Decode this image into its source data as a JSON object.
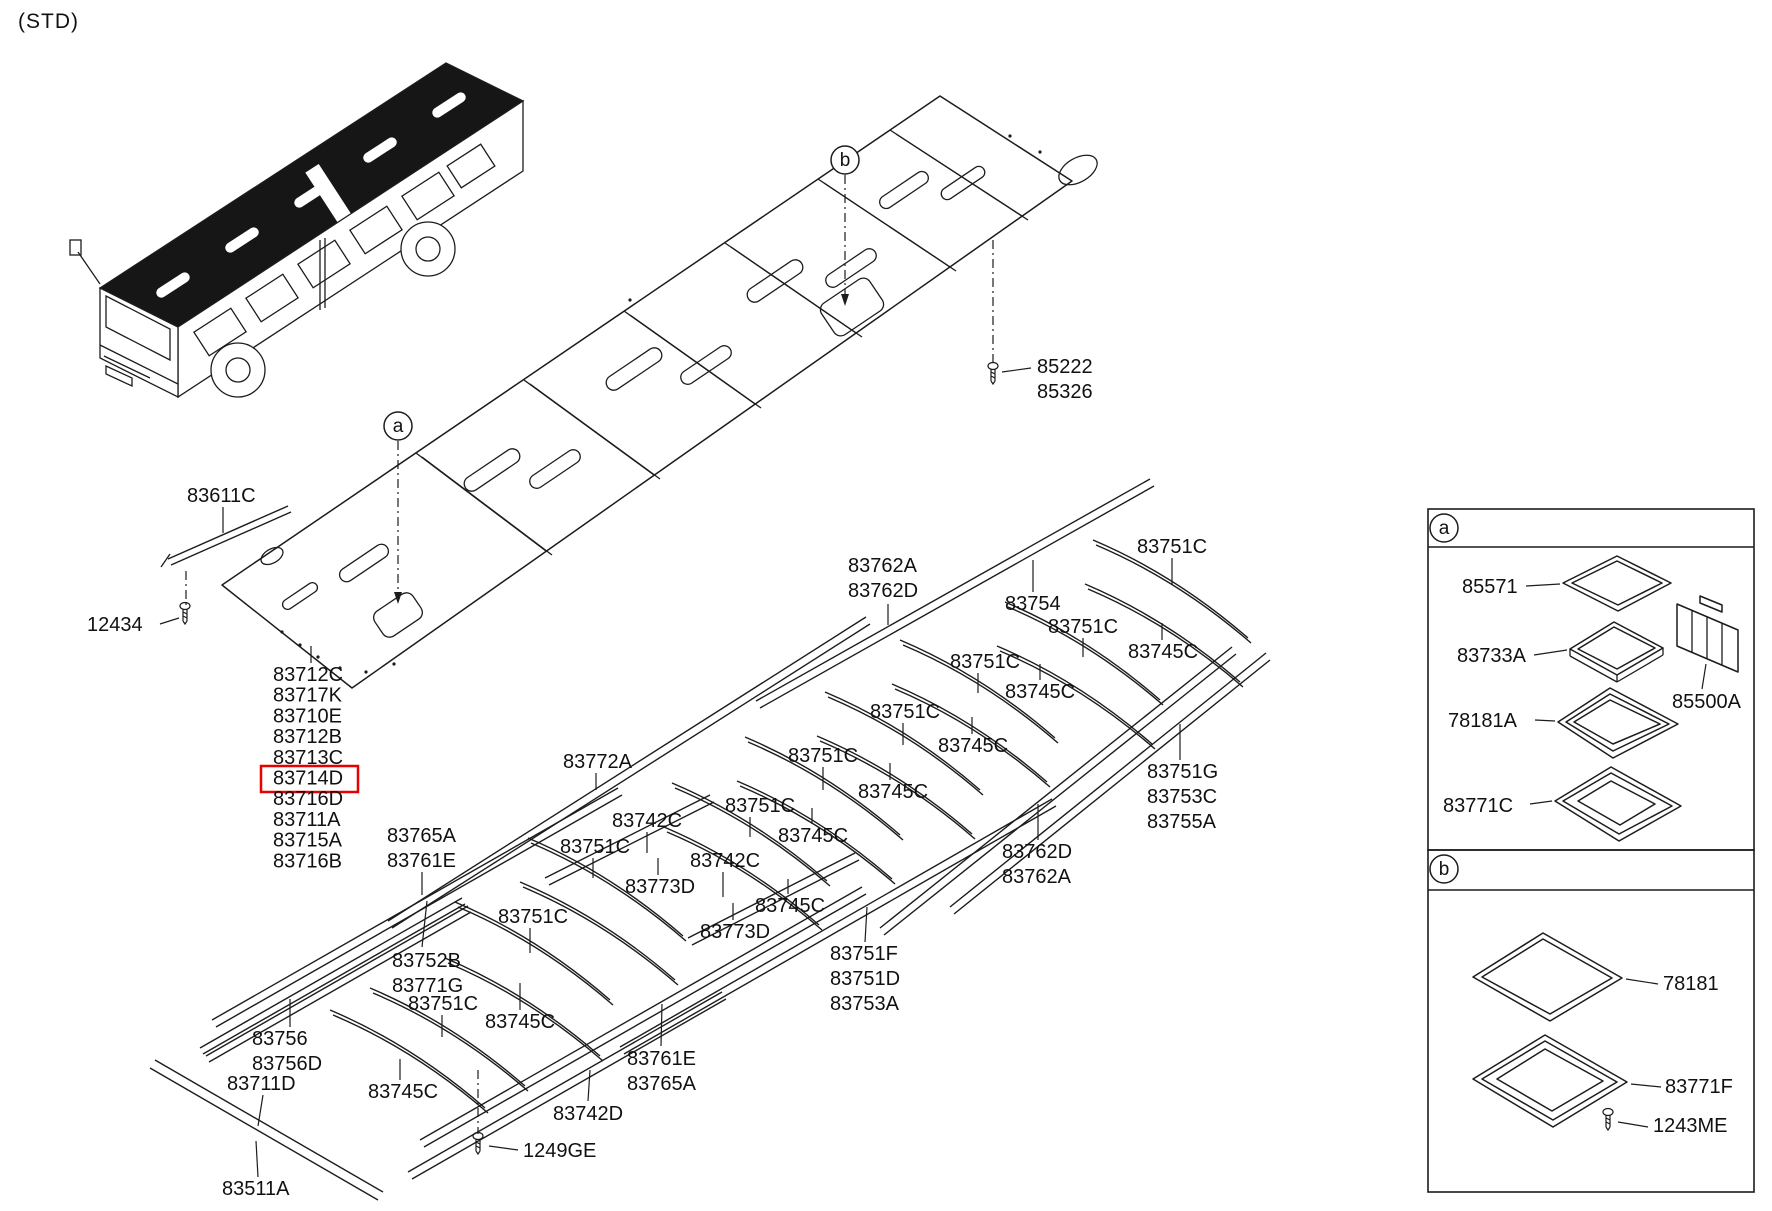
{
  "page": {
    "variant_tag": "(STD)"
  },
  "colors": {
    "line": "#1c1c1c",
    "highlight": "#e60000",
    "bg": "#ffffff"
  },
  "parts_list": {
    "x": 273,
    "y0": 681,
    "dy": 20.7,
    "items": [
      "83712C",
      "83717K",
      "83710E",
      "83712B",
      "83713C",
      "83714D",
      "83716D",
      "83711A",
      "83715A",
      "83716B"
    ],
    "highlighted_index": 5,
    "highlight_box": [
      261,
      766,
      97,
      26
    ],
    "leader": [
      311,
      646,
      311,
      663
    ]
  },
  "callouts": [
    {
      "x": 398,
      "y": 426,
      "t": "a"
    },
    {
      "x": 845,
      "y": 160,
      "t": "b"
    },
    {
      "x": 1444,
      "y": 528,
      "t": "a"
    },
    {
      "x": 1444,
      "y": 869,
      "t": "b"
    }
  ],
  "detail_boxes": [
    {
      "x": 1428,
      "y": 509,
      "w": 326,
      "h": 341,
      "div_y": 547,
      "id": "a"
    },
    {
      "x": 1428,
      "y": 850,
      "w": 326,
      "h": 342,
      "div_y": 890,
      "id": "b"
    }
  ],
  "labels": [
    {
      "n": "label-83611C",
      "t": [
        "83611C"
      ],
      "x": 187,
      "y": 502,
      "l": [
        223,
        507,
        223,
        533
      ]
    },
    {
      "n": "label-12434",
      "t": [
        "12434"
      ],
      "x": 87,
      "y": 631,
      "l": [
        160,
        624,
        179,
        618
      ]
    },
    {
      "n": "label-85222-85326",
      "t": [
        "85222",
        "85326"
      ],
      "x": 1037,
      "y": 373,
      "l": [
        1031,
        368,
        1002,
        372
      ]
    },
    {
      "n": "label-83762A-83762D",
      "t": [
        "83762A",
        "83762D"
      ],
      "x": 848,
      "y": 572,
      "l": [
        888,
        604,
        888,
        625
      ]
    },
    {
      "n": "label-83754",
      "t": [
        "83754"
      ],
      "x": 1005,
      "y": 610,
      "l": [
        1033,
        592,
        1033,
        560
      ]
    },
    {
      "n": "label-83772A",
      "t": [
        "83772A"
      ],
      "x": 563,
      "y": 768,
      "l": [
        596,
        773,
        596,
        790
      ]
    },
    {
      "n": "label-83742C-1",
      "t": [
        "83742C"
      ],
      "x": 612,
      "y": 827,
      "l": [
        647,
        832,
        647,
        853
      ]
    },
    {
      "n": "label-83742C-2",
      "t": [
        "83742C"
      ],
      "x": 690,
      "y": 867,
      "l": [
        723,
        872,
        723,
        897
      ]
    },
    {
      "n": "label-83773D-1",
      "t": [
        "83773D"
      ],
      "x": 625,
      "y": 893,
      "l": [
        658,
        875,
        658,
        858
      ]
    },
    {
      "n": "label-83773D-2",
      "t": [
        "83773D"
      ],
      "x": 700,
      "y": 938,
      "l": [
        733,
        920,
        733,
        903
      ]
    },
    {
      "n": "label-83745C-1",
      "t": [
        "83745C"
      ],
      "x": 1128,
      "y": 658,
      "l": [
        1162,
        640,
        1162,
        623
      ]
    },
    {
      "n": "label-83745C-2",
      "t": [
        "83745C"
      ],
      "x": 1005,
      "y": 698,
      "l": [
        1040,
        680,
        1040,
        664
      ]
    },
    {
      "n": "label-83745C-3",
      "t": [
        "83745C"
      ],
      "x": 938,
      "y": 752,
      "l": [
        972,
        734,
        972,
        717
      ]
    },
    {
      "n": "label-83745C-4",
      "t": [
        "83745C"
      ],
      "x": 858,
      "y": 798,
      "l": [
        890,
        780,
        890,
        763
      ]
    },
    {
      "n": "label-83745C-5",
      "t": [
        "83745C"
      ],
      "x": 778,
      "y": 842,
      "l": [
        812,
        824,
        812,
        808
      ]
    },
    {
      "n": "label-83745C-6",
      "t": [
        "83745C"
      ],
      "x": 755,
      "y": 912,
      "l": [
        788,
        894,
        788,
        879
      ]
    },
    {
      "n": "label-83745C-7",
      "t": [
        "83745C"
      ],
      "x": 485,
      "y": 1028,
      "l": [
        520,
        1010,
        520,
        983
      ]
    },
    {
      "n": "label-83745C-8",
      "t": [
        "83745C"
      ],
      "x": 368,
      "y": 1098,
      "l": [
        400,
        1080,
        400,
        1059
      ]
    },
    {
      "n": "label-83751C-1",
      "t": [
        "83751C"
      ],
      "x": 1137,
      "y": 553,
      "l": [
        1172,
        558,
        1172,
        585
      ]
    },
    {
      "n": "label-83751C-2",
      "t": [
        "83751C"
      ],
      "x": 1048,
      "y": 633,
      "l": [
        1083,
        638,
        1083,
        657
      ]
    },
    {
      "n": "label-83751C-3",
      "t": [
        "83751C"
      ],
      "x": 950,
      "y": 668,
      "l": [
        978,
        673,
        978,
        693
      ]
    },
    {
      "n": "label-83751C-4",
      "t": [
        "83751C"
      ],
      "x": 870,
      "y": 718,
      "l": [
        903,
        723,
        903,
        745
      ]
    },
    {
      "n": "label-83751C-5",
      "t": [
        "83751C"
      ],
      "x": 788,
      "y": 762,
      "l": [
        823,
        767,
        823,
        790
      ]
    },
    {
      "n": "label-83751C-6",
      "t": [
        "83751C"
      ],
      "x": 725,
      "y": 812,
      "l": [
        750,
        817,
        750,
        837
      ]
    },
    {
      "n": "label-83751C-7",
      "t": [
        "83751C"
      ],
      "x": 560,
      "y": 853,
      "l": [
        593,
        858,
        593,
        878
      ]
    },
    {
      "n": "label-83751C-8",
      "t": [
        "83751C"
      ],
      "x": 498,
      "y": 923,
      "l": [
        530,
        928,
        530,
        953
      ]
    },
    {
      "n": "label-83751C-9",
      "t": [
        "83751C"
      ],
      "x": 408,
      "y": 1010,
      "l": [
        442,
        1015,
        442,
        1037
      ]
    },
    {
      "n": "label-83765A-83761E",
      "t": [
        "83765A",
        "83761E"
      ],
      "x": 387,
      "y": 842,
      "l": [
        422,
        872,
        422,
        895
      ]
    },
    {
      "n": "label-83752B-83771G",
      "t": [
        "83752B",
        "83771G"
      ],
      "x": 392,
      "y": 967,
      "l": [
        422,
        947,
        427,
        901
      ]
    },
    {
      "n": "label-83751F-83751D-83753A",
      "t": [
        "83751F",
        "83751D",
        "83753A"
      ],
      "x": 830,
      "y": 960,
      "l": [
        865,
        942,
        867,
        907
      ]
    },
    {
      "n": "label-83762D-83762A",
      "t": [
        "83762D",
        "83762A"
      ],
      "x": 1002,
      "y": 858,
      "l": [
        1038,
        840,
        1038,
        804
      ]
    },
    {
      "n": "label-83751G-83753C-83755A",
      "t": [
        "83751G",
        "83753C",
        "83755A"
      ],
      "x": 1147,
      "y": 778,
      "l": [
        1180,
        760,
        1180,
        724
      ]
    },
    {
      "n": "label-83761E-83765A",
      "t": [
        "83761E",
        "83765A"
      ],
      "x": 627,
      "y": 1065,
      "l": [
        661,
        1046,
        662,
        1004
      ]
    },
    {
      "n": "label-83742D",
      "t": [
        "83742D"
      ],
      "x": 553,
      "y": 1120,
      "l": [
        588,
        1101,
        590,
        1070
      ]
    },
    {
      "n": "label-1249GE",
      "t": [
        "1249GE"
      ],
      "x": 523,
      "y": 1157,
      "l": [
        518,
        1150,
        489,
        1146
      ]
    },
    {
      "n": "label-83756-83756D",
      "t": [
        "83756",
        "83756D"
      ],
      "x": 252,
      "y": 1045,
      "l": [
        290,
        1027,
        290,
        999
      ]
    },
    {
      "n": "label-83711D",
      "t": [
        "83711D"
      ],
      "x": 227,
      "y": 1090,
      "l": [
        263,
        1095,
        258,
        1126
      ]
    },
    {
      "n": "label-83511A",
      "t": [
        "83511A"
      ],
      "x": 222,
      "y": 1195,
      "l": [
        258,
        1177,
        256,
        1141
      ]
    },
    {
      "n": "label-85571",
      "t": [
        "85571"
      ],
      "x": 1462,
      "y": 593,
      "l": [
        1526,
        586,
        1560,
        584
      ]
    },
    {
      "n": "label-83733A",
      "t": [
        "83733A"
      ],
      "x": 1457,
      "y": 662,
      "l": [
        1534,
        655,
        1567,
        650
      ]
    },
    {
      "n": "label-78181A",
      "t": [
        "78181A"
      ],
      "x": 1448,
      "y": 727,
      "l": [
        1535,
        720,
        1555,
        721
      ]
    },
    {
      "n": "label-85500A",
      "t": [
        "85500A"
      ],
      "x": 1672,
      "y": 708,
      "l": [
        1702,
        689,
        1706,
        664
      ]
    },
    {
      "n": "label-83771C",
      "t": [
        "83771C"
      ],
      "x": 1443,
      "y": 812,
      "l": [
        1530,
        804,
        1552,
        801
      ]
    },
    {
      "n": "label-78181",
      "t": [
        "78181"
      ],
      "x": 1663,
      "y": 990,
      "l": [
        1658,
        984,
        1626,
        979
      ]
    },
    {
      "n": "label-83771F",
      "t": [
        "83771F"
      ],
      "x": 1665,
      "y": 1093,
      "l": [
        1661,
        1087,
        1631,
        1084
      ]
    },
    {
      "n": "label-1243ME",
      "t": [
        "1243ME"
      ],
      "x": 1653,
      "y": 1132,
      "l": [
        1648,
        1127,
        1618,
        1122
      ]
    }
  ],
  "artwork": {
    "polys": [
      {
        "p": "222,585 940,96 1072,181 352,688"
      },
      {
        "p": "1563,583 1617,556 1671,583 1618,611"
      },
      {
        "p": "1572,583 1617,561 1662,583 1618,605"
      },
      {
        "p": "1570,649 1614,622 1663,648 1617,675"
      },
      {
        "p": "1578,649 1614,627 1655,648 1617,669"
      },
      {
        "p": "1558,722 1610,688 1678,724 1613,758"
      },
      {
        "p": "1566,722 1610,694 1669,724 1613,751"
      },
      {
        "p": "1574,722 1610,700 1660,724 1613,744"
      },
      {
        "p": "1677,604 1738,630 1738,672 1677,646"
      },
      {
        "p": "1700,596 1722,605 1722,612 1700,603"
      },
      {
        "p": "1555,801 1611,767 1681,806 1619,841"
      },
      {
        "p": "1563,801 1611,773 1672,806 1619,834"
      },
      {
        "p": "1578,801 1611,781 1655,804 1620,825"
      },
      {
        "p": "1473,977 1543,933 1622,978 1550,1021"
      },
      {
        "p": "1482,977 1543,939 1612,978 1550,1014"
      },
      {
        "p": "1473,1079 1545,1035 1627,1082 1553,1127"
      },
      {
        "p": "1482,1079 1545,1041 1617,1082 1553,1120"
      },
      {
        "p": "1497,1079 1545,1049 1603,1081 1552,1111"
      }
    ],
    "rails": [
      [
        168,
        559,
        288,
        506,
        3,
        6
      ],
      [
        388,
        921,
        866,
        617,
        4,
        7
      ],
      [
        756,
        701,
        1150,
        479,
        4,
        7
      ],
      [
        212,
        1020,
        618,
        788,
        4,
        7
      ],
      [
        420,
        1140,
        862,
        887,
        4,
        7
      ],
      [
        408,
        1172,
        722,
        992,
        4,
        7
      ],
      [
        620,
        1047,
        1052,
        799,
        4,
        7
      ],
      [
        880,
        928,
        1232,
        647,
        4,
        7
      ],
      [
        950,
        907,
        1266,
        653,
        4,
        7
      ],
      [
        150,
        1068,
        378,
        1200,
        5,
        -8
      ],
      [
        545,
        878,
        710,
        795,
        4,
        7
      ],
      [
        688,
        938,
        855,
        853,
        4,
        7
      ],
      [
        200,
        1048,
        462,
        898,
        3,
        6
      ],
      [
        206,
        1056,
        468,
        906,
        3,
        6
      ]
    ],
    "arcs": [
      [
        1093,
        540,
        1248,
        638
      ],
      [
        1085,
        584,
        1240,
        682
      ],
      [
        1005,
        602,
        1160,
        700
      ],
      [
        997,
        646,
        1152,
        744
      ],
      [
        900,
        640,
        1055,
        738
      ],
      [
        892,
        684,
        1047,
        782
      ],
      [
        825,
        692,
        980,
        790
      ],
      [
        817,
        736,
        972,
        834
      ],
      [
        745,
        737,
        900,
        835
      ],
      [
        737,
        781,
        892,
        879
      ],
      [
        672,
        783,
        827,
        881
      ],
      [
        664,
        827,
        819,
        925
      ],
      [
        528,
        838,
        683,
        936
      ],
      [
        520,
        882,
        675,
        980
      ],
      [
        455,
        902,
        610,
        1000
      ],
      [
        445,
        958,
        600,
        1056
      ],
      [
        370,
        988,
        525,
        1086
      ],
      [
        330,
        1010,
        485,
        1108
      ]
    ],
    "lines": [
      [
        416,
        453,
        546,
        551
      ],
      [
        422,
        457,
        552,
        555
      ],
      [
        524,
        380,
        654,
        475
      ],
      [
        530,
        384,
        660,
        479
      ],
      [
        624,
        311,
        755,
        404
      ],
      [
        630,
        315,
        761,
        408
      ],
      [
        725,
        243,
        856,
        333
      ],
      [
        731,
        247,
        862,
        337
      ],
      [
        818,
        179,
        950,
        267
      ],
      [
        824,
        183,
        956,
        271
      ],
      [
        890,
        130,
        1022,
        216
      ],
      [
        896,
        134,
        1028,
        220
      ],
      [
        1570,
        649,
        1570,
        656
      ],
      [
        1617,
        675,
        1617,
        682
      ],
      [
        1663,
        648,
        1663,
        655
      ],
      [
        1570,
        656,
        1617,
        682
      ],
      [
        1617,
        682,
        1663,
        655
      ],
      [
        161,
        567,
        170,
        554
      ],
      [
        1692,
        610,
        1692,
        652
      ],
      [
        1707,
        617,
        1707,
        659
      ],
      [
        1722,
        623,
        1722,
        665
      ]
    ],
    "dashes": [
      [
        186,
        571,
        186,
        606
      ],
      [
        993,
        240,
        993,
        364
      ],
      [
        478,
        1070,
        478,
        1134
      ]
    ],
    "arrows": [
      {
        "x": 398,
        "y1": 441,
        "y2": 592
      },
      {
        "x": 845,
        "y1": 175,
        "y2": 294
      }
    ],
    "slots": [
      [
        492,
        470,
        64,
        15
      ],
      [
        555,
        469,
        58,
        14
      ],
      [
        634,
        369,
        64,
        15
      ],
      [
        706,
        365,
        58,
        14
      ],
      [
        775,
        281,
        64,
        15
      ],
      [
        851,
        268,
        58,
        14
      ],
      [
        904,
        190,
        56,
        13
      ],
      [
        963,
        183,
        50,
        12
      ],
      [
        364,
        563,
        56,
        14
      ],
      [
        300,
        596,
        40,
        10
      ],
      [
        398,
        615,
        46,
        30
      ],
      [
        852,
        307,
        58,
        38
      ]
    ],
    "holes": [
      [
        1078,
        170,
        21,
        12,
        -30
      ],
      [
        272,
        556,
        12,
        7,
        -30
      ]
    ],
    "dots": [
      [
        282,
        632
      ],
      [
        300,
        645
      ],
      [
        318,
        657
      ],
      [
        340,
        668
      ],
      [
        366,
        672
      ],
      [
        394,
        664
      ],
      [
        630,
        300
      ],
      [
        1010,
        136
      ],
      [
        1040,
        152
      ]
    ],
    "screws": [
      {
        "x": 185,
        "y": 613,
        "n": "screw-12434-icon"
      },
      {
        "x": 993,
        "y": 373,
        "n": "screw-85222-icon"
      },
      {
        "x": 478,
        "y": 1143,
        "n": "screw-1249GE-icon"
      },
      {
        "x": 1608,
        "y": 1119,
        "n": "screw-1243ME-icon"
      }
    ]
  }
}
